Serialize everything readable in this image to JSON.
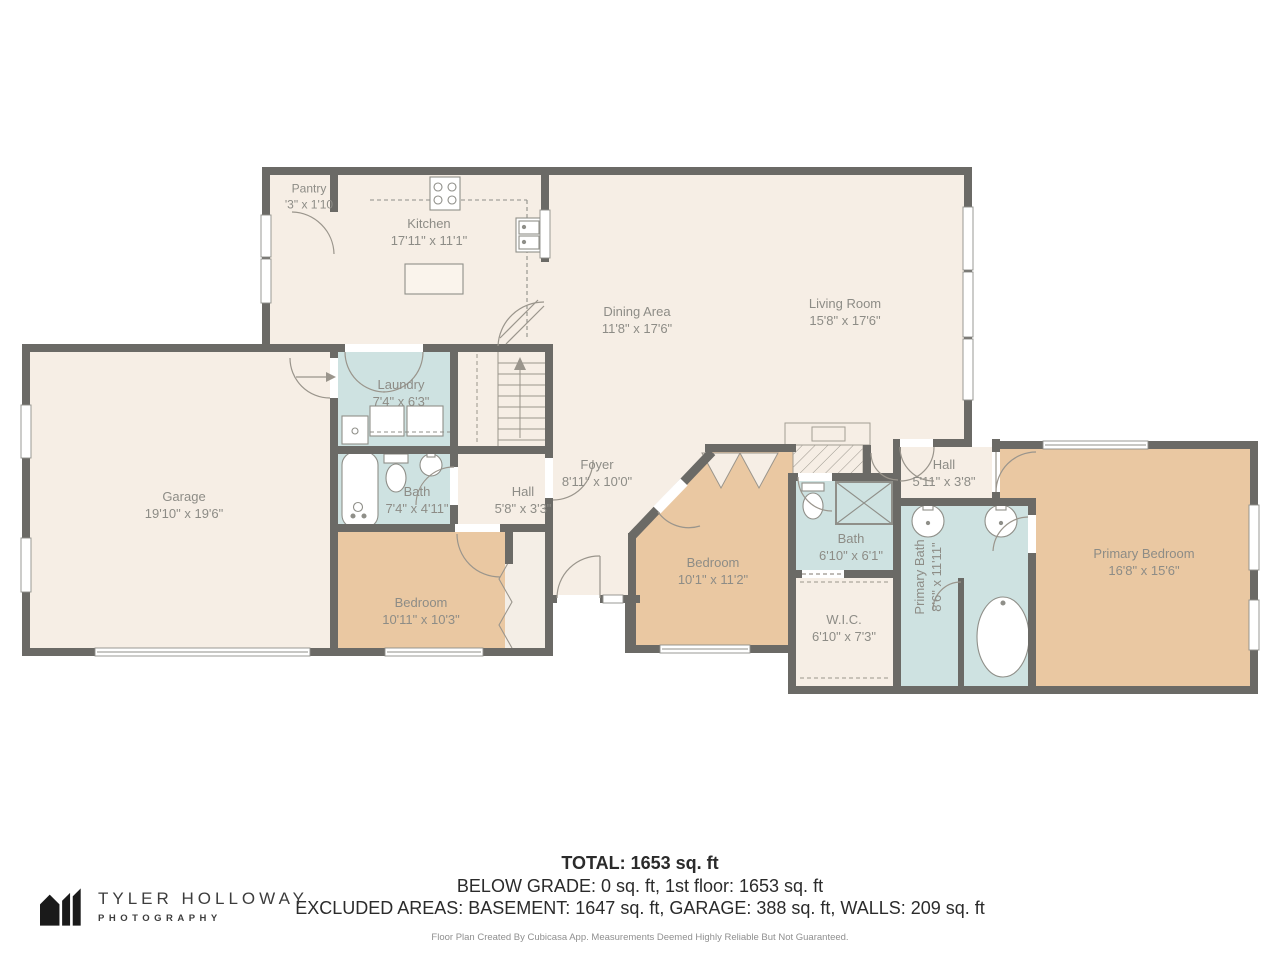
{
  "plan": {
    "rooms": [
      {
        "name": "Pantry",
        "dims": "'3\" x 1'10"
      },
      {
        "name": "Kitchen",
        "dims": "17'11\" x 11'1\""
      },
      {
        "name": "Dining Area",
        "dims": "11'8\" x 17'6\""
      },
      {
        "name": "Living Room",
        "dims": "15'8\" x 17'6\""
      },
      {
        "name": "Garage",
        "dims": "19'10\" x 19'6\""
      },
      {
        "name": "Laundry",
        "dims": "7'4\" x 6'3\""
      },
      {
        "name": "Bath",
        "dims": "7'4\" x 4'11\""
      },
      {
        "name": "Hall",
        "dims": "5'8\" x 3'3\""
      },
      {
        "name": "Bedroom",
        "dims": "10'11\" x 10'3\""
      },
      {
        "name": "Foyer",
        "dims": "8'11\" x 10'0\""
      },
      {
        "name": "Bedroom",
        "dims": "10'1\" x 11'2\""
      },
      {
        "name": "Bath",
        "dims": "6'10\" x 6'1\""
      },
      {
        "name": "W.I.C.",
        "dims": "6'10\" x 7'3\""
      },
      {
        "name": "Hall",
        "dims": "5'11\" x 3'8\""
      },
      {
        "name": "Primary Bath",
        "dims": "8'6\" x 11'11\""
      },
      {
        "name": "Primary Bedroom",
        "dims": "16'8\" x 15'6\""
      }
    ],
    "colors": {
      "wall": "#6b6a66",
      "floor": "#f6eee5",
      "bedroom_floor": "#eac8a2",
      "wet_room_floor": "#cee2e1",
      "label_text": "#8d8c86"
    }
  },
  "summary": {
    "total": "TOTAL: 1653 sq. ft",
    "below_grade": "BELOW GRADE: 0 sq. ft, 1st floor: 1653 sq. ft",
    "excluded": "EXCLUDED AREAS: BASEMENT: 1647 sq. ft, GARAGE: 388 sq. ft, WALLS: 209 sq. ft",
    "disclaimer": "Floor Plan Created By Cubicasa App. Measurements Deemed Highly Reliable But Not Guaranteed."
  },
  "logo": {
    "brand": "TYLER HOLLOWAY",
    "tagline": "PHOTOGRAPHY"
  }
}
